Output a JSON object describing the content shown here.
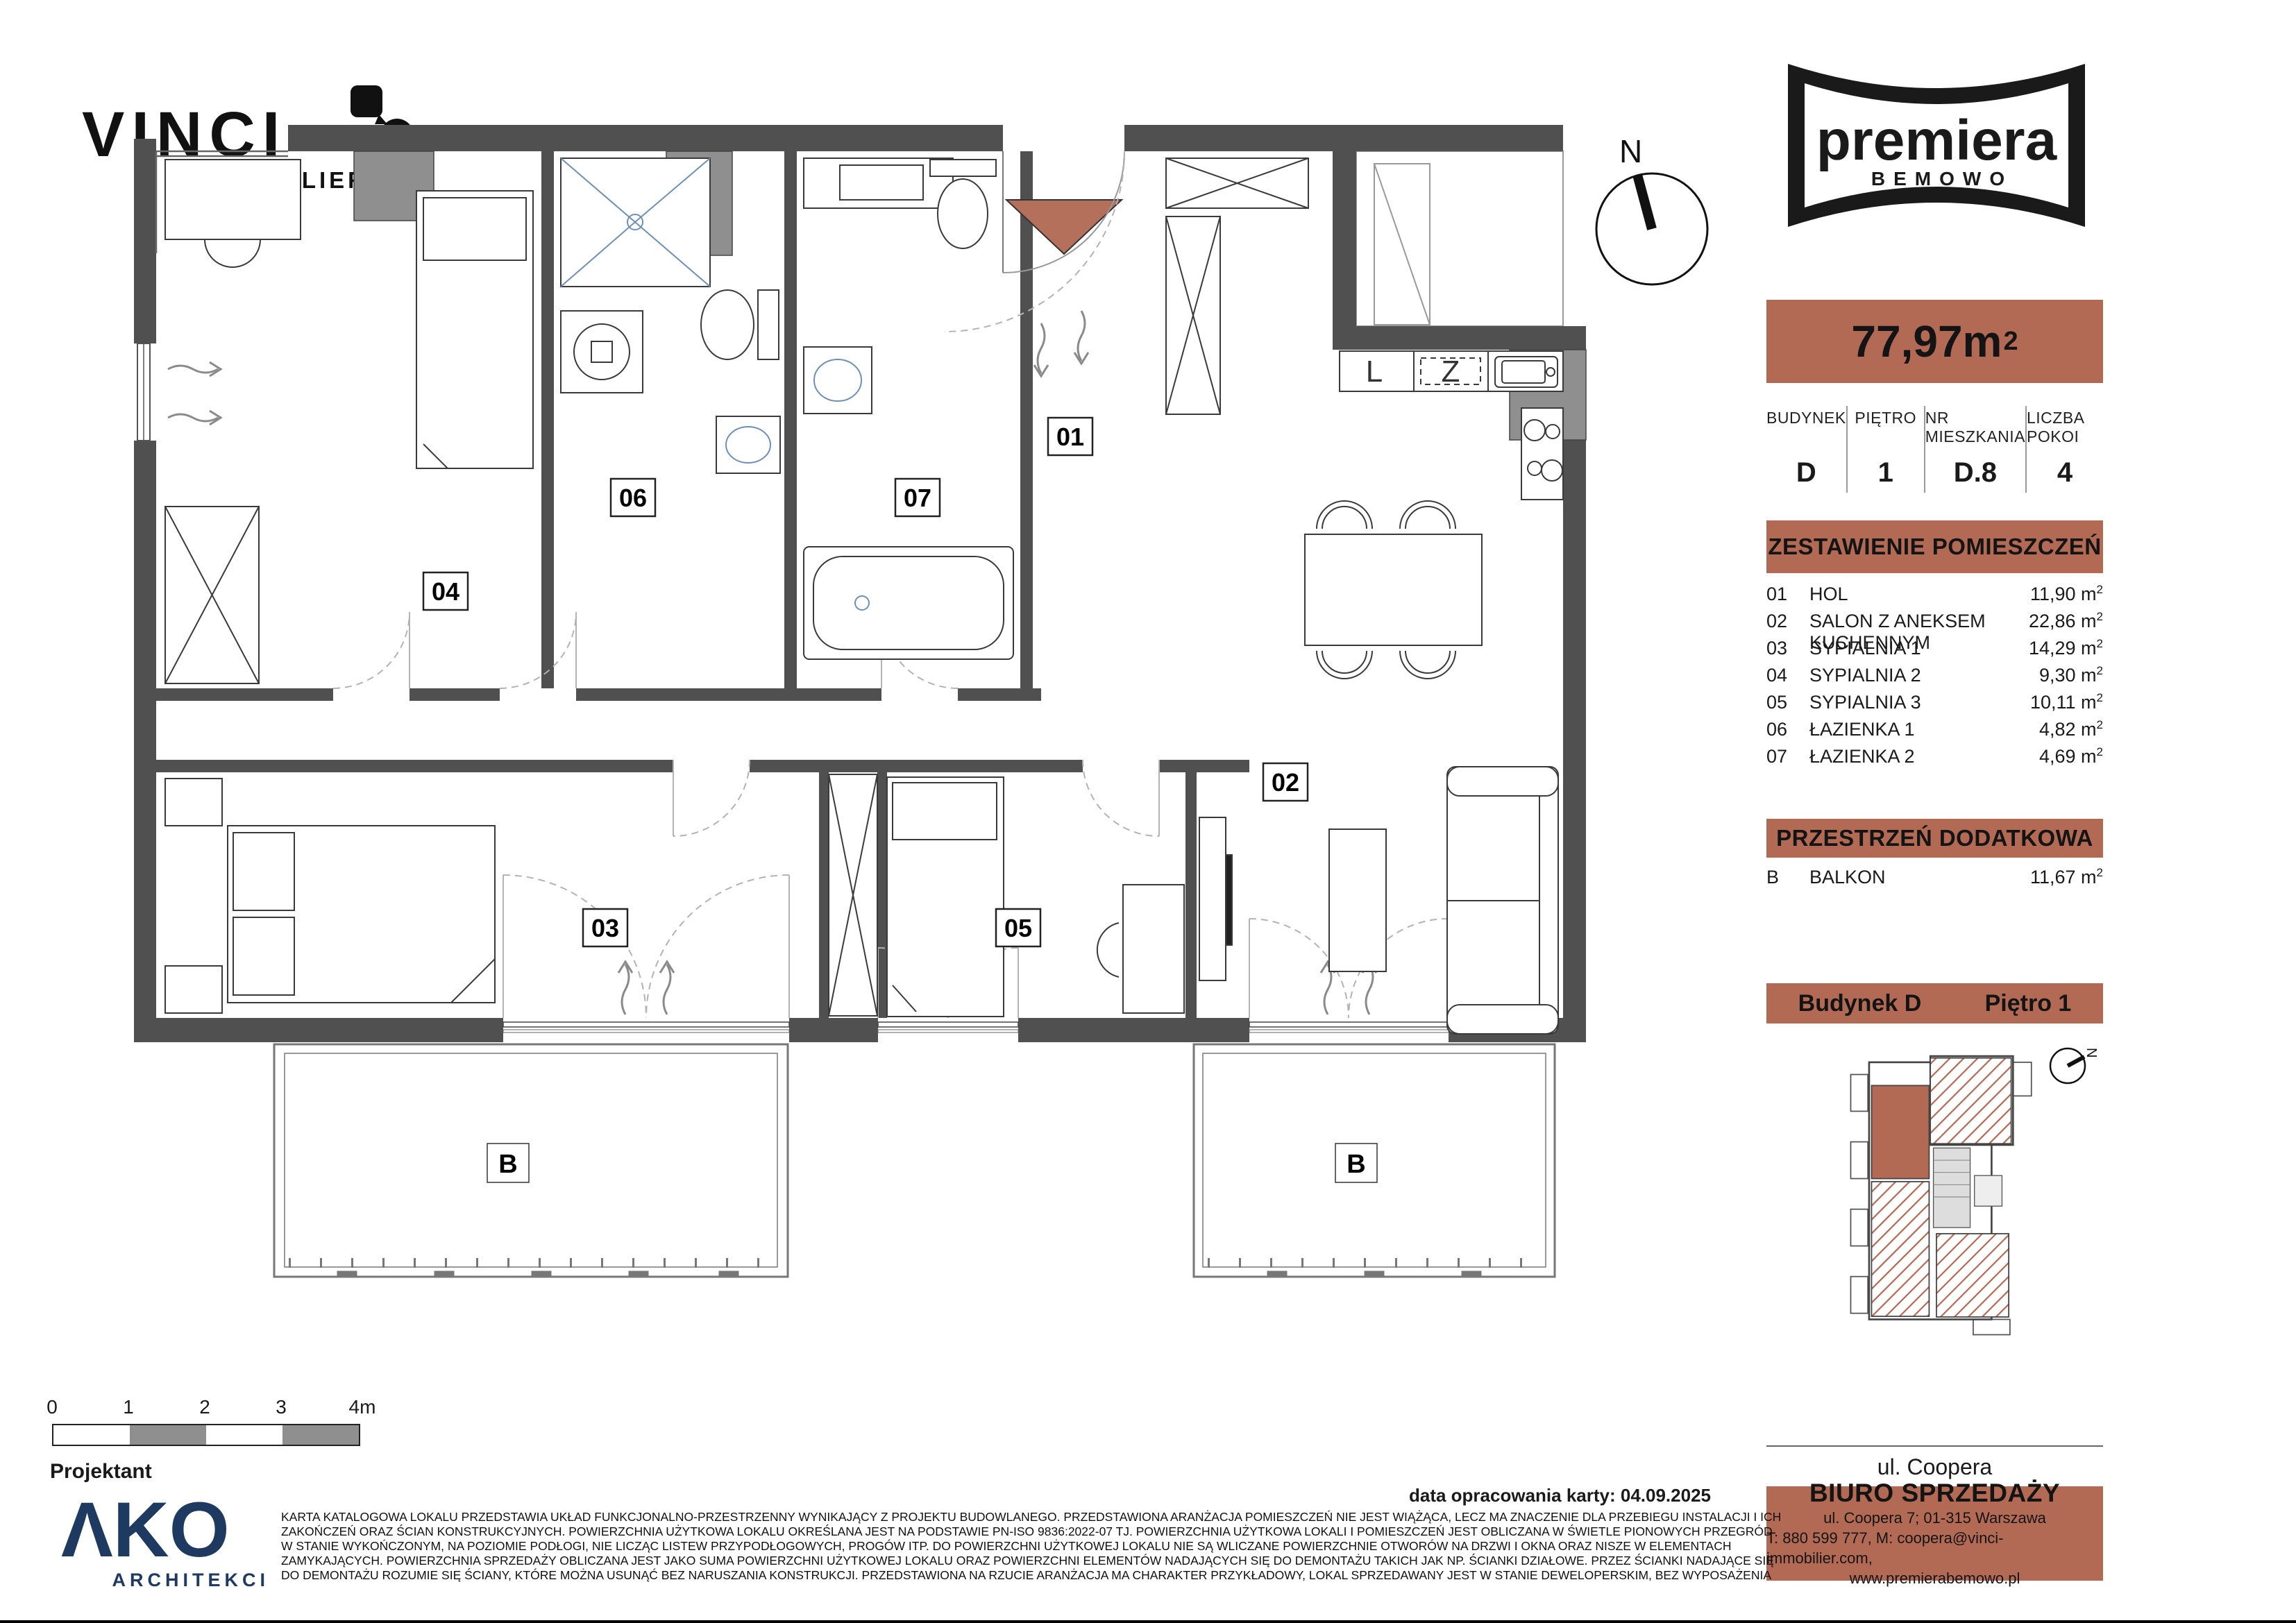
{
  "colors": {
    "accent": "#b26a55",
    "wall": "#505050",
    "shaft": "#8f8f8f",
    "navy": "#1e3a60",
    "triangle": "#b5705b"
  },
  "branding": {
    "developer": {
      "name": "VINCI",
      "sub": "IMMOBILIER"
    },
    "project": {
      "name": "premiera",
      "sub": "BEMOWO"
    }
  },
  "apartment": {
    "area_value": "77,97m",
    "area_sup": "2",
    "info": [
      {
        "label": "BUDYNEK",
        "value": "D"
      },
      {
        "label": "PIĘTRO",
        "value": "1"
      },
      {
        "label": "NR MIESZKANIA",
        "value": "D.8"
      },
      {
        "label": "LICZBA POKOI",
        "value": "4"
      }
    ]
  },
  "sections": {
    "rooms_title": "ZESTAWIENIE POMIESZCZEŃ",
    "extra_title": "PRZESTRZEŃ DODATKOWA",
    "building_label": "Budynek  D",
    "floor_label": "Piętro 1"
  },
  "units": {
    "m": "m",
    "sup": "2"
  },
  "rooms": [
    {
      "num": "01",
      "name": "HOL",
      "area": "11,90"
    },
    {
      "num": "02",
      "name": "SALON Z ANEKSEM KUCHENNYM",
      "area": "22,86"
    },
    {
      "num": "03",
      "name": "SYPIALNIA 1",
      "area": "14,29"
    },
    {
      "num": "04",
      "name": "SYPIALNIA 2",
      "area": "9,30"
    },
    {
      "num": "05",
      "name": "SYPIALNIA 3",
      "area": "10,11"
    },
    {
      "num": "06",
      "name": "ŁAZIENKA 1",
      "area": "4,82"
    },
    {
      "num": "07",
      "name": "ŁAZIENKA 2",
      "area": "4,69"
    }
  ],
  "extra": {
    "num": "B",
    "name": "BALKON",
    "area": "11,67"
  },
  "street": "ul. Coopera",
  "office": {
    "title": "BIURO SPRZEDAŻY",
    "line1": "ul. Coopera 7; 01-315 Warszawa",
    "line2": "T: 880 599 777, M: coopera@vinci-immobilier.com,",
    "line3": "www.premierabemowo.pl"
  },
  "date_line": "data opracowania karty: 04.09.2025",
  "projektant": "Projektant",
  "architect": {
    "logo": "ΛKO",
    "sub": "ARCHITEKCI"
  },
  "scale": {
    "labels": [
      "0",
      "1",
      "2",
      "3",
      "4m"
    ]
  },
  "plan": {
    "labels": {
      "r01": "01",
      "r02": "02",
      "r03": "03",
      "r04": "04",
      "r05": "05",
      "r06": "06",
      "r07": "07",
      "b": "B",
      "n": "N",
      "l": "L",
      "z": "Z"
    }
  },
  "disclaimer": [
    "KARTA KATALOGOWA LOKALU PRZEDSTAWIA UKŁAD FUNKCJONALNO-PRZESTRZENNY WYNIKAJĄCY Z PROJEKTU BUDOWLANEGO. PRZEDSTAWIONA ARANŻACJA POMIESZCZEŃ NIE JEST WIĄŻĄCA, LECZ MA ZNACZENIE DLA PRZEBIEGU INSTALACJI I ICH",
    "ZAKOŃCZEŃ ORAZ ŚCIAN KONSTRUKCYJNYCH. POWIERZCHNIA UŻYTKOWA LOKALU OKREŚLANA JEST NA PODSTAWIE PN-ISO 9836:2022-07 TJ. POWIERZCHNIA UŻYTKOWA LOKALI I POMIESZCZEŃ JEST OBLICZANA W ŚWIETLE PIONOWYCH PRZEGRÓD",
    "W STANIE WYKOŃCZONYM, NA POZIOMIE PODŁOGI, NIE LICZĄC LISTEW PRZYPODŁOGOWYCH, PROGÓW ITP. DO POWIERZCHNI UŻYTKOWEJ LOKALU NIE SĄ WLICZANE POWIERZCHNIE OTWORÓW NA DRZWI I OKNA ORAZ NISZE W ELEMENTACH",
    "ZAMYKAJĄCYCH. POWIERZCHNIA SPRZEDAŻY OBLICZANA JEST JAKO SUMA POWIERZCHNI UŻYTKOWEJ LOKALU ORAZ POWIERZCHNI ELEMENTÓW NADAJĄCYCH SIĘ DO DEMONTAŻU TAKICH JAK NP. ŚCIANKI DZIAŁOWE. PRZEZ ŚCIANKI NADAJĄCE SIĘ",
    "DO DEMONTAŻU ROZUMIE SIĘ ŚCIANY, KTÓRE MOŻNA USUNĄĆ BEZ NARUSZANIA KONSTRUKCJI. PRZEDSTAWIONA NA RZUCIE ARANŻACJA MA CHARAKTER PRZYKŁADOWY, LOKAL SPRZEDAWANY JEST W STANIE DEWELOPERSKIM, BEZ WYPOSAŻENIA"
  ]
}
